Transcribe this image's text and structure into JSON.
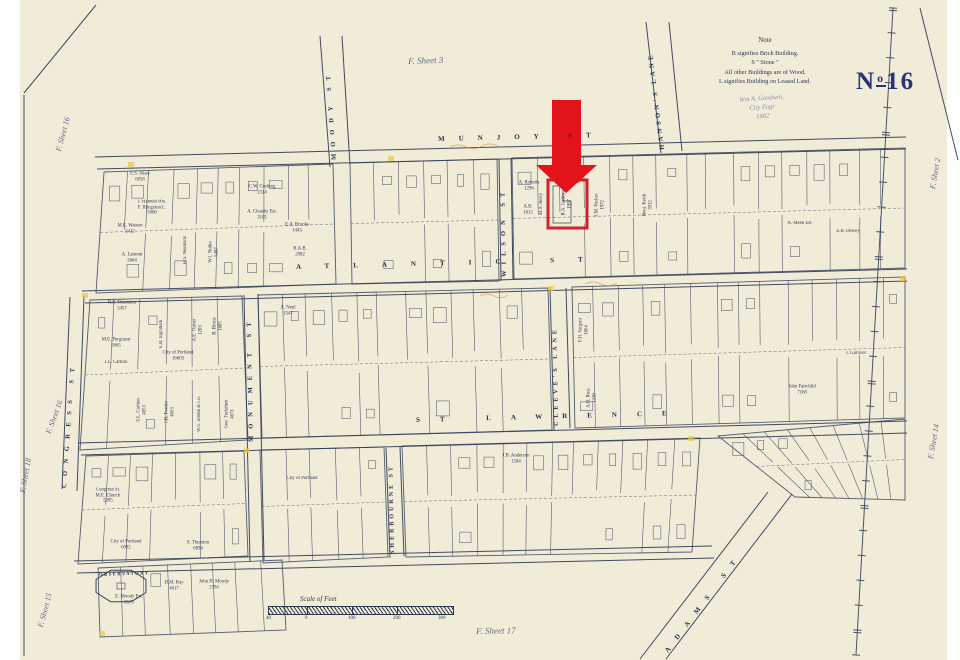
{
  "map_sheet": {
    "number": {
      "prefix": "N",
      "sup": "o",
      "digits": "16"
    },
    "notes": {
      "title": "Note",
      "lines": [
        "B signifies Brick Building.",
        "S      \"      Stone      \"",
        "All other Buildings are of Wood.",
        "L signifies Building on Leased Land."
      ],
      "signature": [
        "Wm A. Goodwin,",
        "City Engr",
        "1882"
      ]
    },
    "scale": {
      "label": "Scale of Feet",
      "ticks": [
        {
          "label": "40",
          "x": 266
        },
        {
          "label": "0",
          "x": 305
        },
        {
          "label": "100",
          "x": 348
        },
        {
          "label": "200",
          "x": 393
        },
        {
          "label": "300",
          "x": 438
        }
      ]
    },
    "sheet_refs": [
      {
        "label": "F. Sheet 3",
        "x": 408,
        "y": 56,
        "rot": -2,
        "fs": 9
      },
      {
        "label": "F. Sheet 2",
        "x": 928,
        "y": 188,
        "rot": -80,
        "fs": 8
      },
      {
        "label": "F. Sheet 16",
        "x": 54,
        "y": 150,
        "rot": -75,
        "fs": 8
      },
      {
        "label": "F. Sheet 16",
        "x": 44,
        "y": 432,
        "rot": -70,
        "fs": 8
      },
      {
        "label": "F. Sheet 18",
        "x": 18,
        "y": 492,
        "rot": -80,
        "fs": 8
      },
      {
        "label": "F. Sheet 15",
        "x": 36,
        "y": 626,
        "rot": -75,
        "fs": 8
      },
      {
        "label": "F. Sheet 14",
        "x": 926,
        "y": 458,
        "rot": -80,
        "fs": 8
      },
      {
        "label": "F. Sheet 17",
        "x": 476,
        "y": 626,
        "rot": -1,
        "fs": 9
      }
    ],
    "streets": [
      {
        "name": "MUNJOY ST",
        "x": 438,
        "y": 136,
        "rot": -1.4,
        "ls": 14,
        "fs": 7
      },
      {
        "name": "ATLANTIC ST",
        "x": 296,
        "y": 264,
        "rot": -1.5,
        "ls": 24,
        "fs": 7
      },
      {
        "name": "ST LAWRENCE",
        "x": 416,
        "y": 417,
        "rot": -1.5,
        "ls": 20,
        "fs": 7
      },
      {
        "name": "MOODY ST",
        "x": 332,
        "y": 160,
        "rot": -94,
        "ls": 7,
        "fs": 6.5
      },
      {
        "name": "HANSON'S LANE",
        "x": 660,
        "y": 150,
        "rot": -97,
        "ls": 3.5,
        "fs": 6.5
      },
      {
        "name": "WILSON ST",
        "x": 502,
        "y": 277,
        "rot": -91,
        "ls": 6,
        "fs": 6.5
      },
      {
        "name": "MONUMENT ST",
        "x": 249,
        "y": 442,
        "rot": -91,
        "ls": 7,
        "fs": 6.5
      },
      {
        "name": "CLEEVE'S LANE",
        "x": 554,
        "y": 426,
        "rot": -91,
        "ls": 4,
        "fs": 6
      },
      {
        "name": "CONGRESS ST",
        "x": 62,
        "y": 488,
        "rot": -86,
        "ls": 7.5,
        "fs": 6.5
      },
      {
        "name": "SHERBOURNE ST",
        "x": 390,
        "y": 554,
        "rot": -91,
        "ls": 3,
        "fs": 6
      },
      {
        "name": "ADAMS ST",
        "x": 664,
        "y": 650,
        "rot": -53,
        "ls": 11,
        "fs": 7
      },
      {
        "name": "OBSERVATORY",
        "x": 99,
        "y": 573,
        "rot": -2,
        "ls": 1.5,
        "fs": 4.6
      }
    ],
    "parcels": [
      {
        "t": "E.S. Shaw\n6858",
        "x": 140,
        "y": 177
      },
      {
        "t": "C.W. Cushing\n2314",
        "x": 262,
        "y": 190
      },
      {
        "t": "J. Hannah Hrs.\nF. Illingston L.\n5660",
        "x": 152,
        "y": 208
      },
      {
        "t": "A. Cleasby Est.\n3105",
        "x": 262,
        "y": 215
      },
      {
        "t": "M.E. Watson\n2412",
        "x": 130,
        "y": 229
      },
      {
        "t": "E.A. Brooks\n1443",
        "x": 297,
        "y": 228
      },
      {
        "t": "R.A.B.\n2082",
        "x": 300,
        "y": 252
      },
      {
        "t": "A. Lamont\n2664",
        "x": 132,
        "y": 258
      },
      {
        "t": "H.S. Neumann",
        "x": 186,
        "y": 250,
        "r": -90
      },
      {
        "t": "W.J. Noble\n5387",
        "x": 214,
        "y": 252,
        "r": -90
      },
      {
        "t": "A. Roberts\n1296",
        "x": 529,
        "y": 186
      },
      {
        "t": "A.B.\n1612",
        "x": 528,
        "y": 210
      },
      {
        "t": "M.A. Berry",
        "x": 542,
        "y": 204,
        "r": -90
      },
      {
        "t": "R.A. Gatley\n1957",
        "x": 567,
        "y": 204,
        "r": -90,
        "red": true
      },
      {
        "t": "J.M. Packer\n1972",
        "x": 600,
        "y": 205,
        "r": -90
      },
      {
        "t": "Benj. Keith\n3912",
        "x": 648,
        "y": 205,
        "r": -90
      },
      {
        "t": "A. Meek Est.",
        "x": 800,
        "y": 224
      },
      {
        "t": "E.B. Dewey",
        "x": 848,
        "y": 232
      },
      {
        "t": "R.S. Neumann\n5457",
        "x": 122,
        "y": 306
      },
      {
        "t": "E.B. Ingraham",
        "x": 162,
        "y": 334,
        "r": -90
      },
      {
        "t": "A.E. Turner\n1203",
        "x": 198,
        "y": 330,
        "r": -90
      },
      {
        "t": "B. Birnie\n1805",
        "x": 218,
        "y": 326,
        "r": -90
      },
      {
        "t": "M.E. Ferguson\n2665",
        "x": 116,
        "y": 343
      },
      {
        "t": "J.L. Carlton",
        "x": 116,
        "y": 363
      },
      {
        "t": "City of Portland\n16603",
        "x": 178,
        "y": 356
      },
      {
        "t": "S.L. Carlton\n4853",
        "x": 142,
        "y": 410,
        "r": -90
      },
      {
        "t": "J.R. Fowler\n4663",
        "x": 170,
        "y": 412,
        "r": -90
      },
      {
        "t": "W.S. Jordan & Co.",
        "x": 200,
        "y": 414,
        "r": -90
      },
      {
        "t": "Geo. Trefethen\n4671",
        "x": 230,
        "y": 414,
        "r": -90
      },
      {
        "t": "A. Noel\n1547",
        "x": 288,
        "y": 311
      },
      {
        "t": "F.H. Sargent\n1864",
        "x": 584,
        "y": 330,
        "r": -90
      },
      {
        "t": "A.H. Ross\n1230",
        "x": 592,
        "y": 398,
        "r": -90
      },
      {
        "t": "John Fairchild\n7168",
        "x": 802,
        "y": 390
      },
      {
        "t": "J. Gulliver",
        "x": 856,
        "y": 354
      },
      {
        "t": "Congress St.\nM.E. Church\n5285",
        "x": 108,
        "y": 496
      },
      {
        "t": "City of Portland\n6985",
        "x": 126,
        "y": 545
      },
      {
        "t": "S. Thurston\n6894",
        "x": 198,
        "y": 546
      },
      {
        "t": "City of Portland",
        "x": 302,
        "y": 479
      },
      {
        "t": "J.B. Anderson\n1584",
        "x": 516,
        "y": 459
      },
      {
        "t": "E. Moody Est.\n8575",
        "x": 129,
        "y": 600
      },
      {
        "t": "D.M. Ray\n4617",
        "x": 174,
        "y": 586
      },
      {
        "t": "John H. Moody\n5794",
        "x": 214,
        "y": 585
      }
    ],
    "highlight": {
      "arrow_color": "#e3131b",
      "box_color": "#d4202a",
      "parcel": "R.A. Gatley 1957"
    },
    "colors": {
      "paper": "#f1ecd8",
      "ink": "#2c3654",
      "line": "#39425c",
      "plate_blue": "#27357f",
      "accent_yellow": "#e6c94c"
    }
  }
}
